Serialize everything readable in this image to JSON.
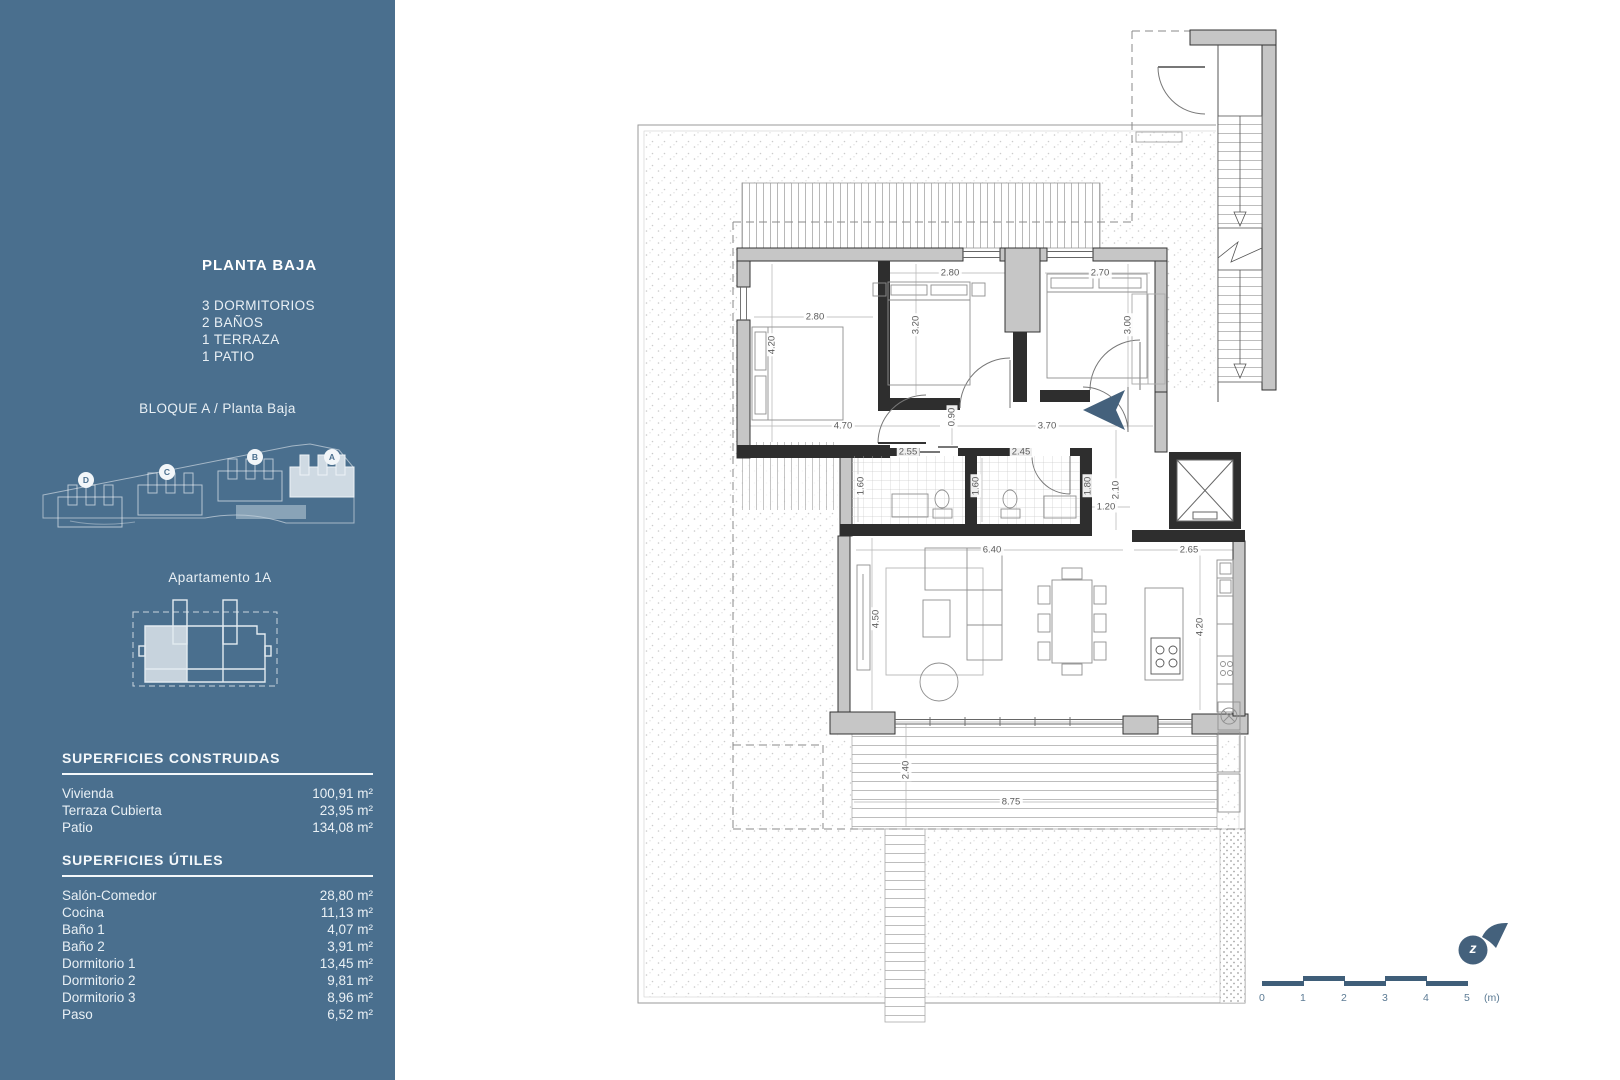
{
  "colors": {
    "accent": "#4a6f8e",
    "accent-dark": "#3f5e79",
    "arrow": "#44617c"
  },
  "sidebar": {
    "title": "PLANTA BAJA",
    "features": [
      "3 DORMITORIOS",
      "2 BAÑOS",
      "1 TERRAZA",
      "1 PATIO"
    ],
    "block_label": "BLOQUE A / Planta Baja",
    "block_badges": [
      "D",
      "C",
      "B",
      "A"
    ],
    "apartment_label": "Apartamento 1A",
    "surfaces_built": {
      "heading": "SUPERFICIES CONSTRUIDAS",
      "rows": [
        {
          "label": "Vivienda",
          "value": "100,91 m²"
        },
        {
          "label": "Terraza Cubierta",
          "value": "23,95 m²"
        },
        {
          "label": "Patio",
          "value": "134,08 m²"
        }
      ]
    },
    "surfaces_useful": {
      "heading": "SUPERFICIES ÚTILES",
      "rows": [
        {
          "label": "Salón-Comedor",
          "value": "28,80 m²"
        },
        {
          "label": "Cocina",
          "value": "11,13 m²"
        },
        {
          "label": "Baño 1",
          "value": "4,07 m²"
        },
        {
          "label": "Baño 2",
          "value": "3,91 m²"
        },
        {
          "label": "Dormitorio 1",
          "value": "13,45 m²"
        },
        {
          "label": "Dormitorio 2",
          "value": "9,81 m²"
        },
        {
          "label": "Dormitorio 3",
          "value": "8,96 m²"
        },
        {
          "label": "Paso",
          "value": "6,52 m²"
        }
      ]
    }
  },
  "floorplan": {
    "dims": [
      {
        "t": "2.80",
        "x": 195,
        "y": 305,
        "v": 0
      },
      {
        "t": "4.20",
        "x": 152,
        "y": 333,
        "v": 1
      },
      {
        "t": "2.80",
        "x": 330,
        "y": 261,
        "v": 0
      },
      {
        "t": "3.20",
        "x": 296,
        "y": 313,
        "v": 1
      },
      {
        "t": "2.70",
        "x": 480,
        "y": 261,
        "v": 0
      },
      {
        "t": "3.00",
        "x": 508,
        "y": 313,
        "v": 1
      },
      {
        "t": "4.70",
        "x": 223,
        "y": 414,
        "v": 0
      },
      {
        "t": "0.90",
        "x": 332,
        "y": 405,
        "v": 1
      },
      {
        "t": "3.70",
        "x": 427,
        "y": 414,
        "v": 0
      },
      {
        "t": "2.55",
        "x": 288,
        "y": 440,
        "v": 0
      },
      {
        "t": "2.45",
        "x": 401,
        "y": 440,
        "v": 0
      },
      {
        "t": "1.60",
        "x": 241,
        "y": 474,
        "v": 1
      },
      {
        "t": "1.60",
        "x": 356,
        "y": 474,
        "v": 1
      },
      {
        "t": "1.80",
        "x": 468,
        "y": 474,
        "v": 1
      },
      {
        "t": "2.10",
        "x": 496,
        "y": 478,
        "v": 1
      },
      {
        "t": "1.20",
        "x": 486,
        "y": 495,
        "v": 0
      },
      {
        "t": "6.40",
        "x": 372,
        "y": 538,
        "v": 0
      },
      {
        "t": "2.65",
        "x": 569,
        "y": 538,
        "v": 0
      },
      {
        "t": "4.50",
        "x": 256,
        "y": 607,
        "v": 1
      },
      {
        "t": "4.20",
        "x": 580,
        "y": 615,
        "v": 1
      },
      {
        "t": "2.40",
        "x": 286,
        "y": 758,
        "v": 1
      },
      {
        "t": "8.75",
        "x": 391,
        "y": 790,
        "v": 0
      }
    ],
    "scale": {
      "ticks": [
        "0",
        "1",
        "2",
        "3",
        "4",
        "5"
      ],
      "unit": "(m)"
    },
    "logo_letter": "z"
  }
}
